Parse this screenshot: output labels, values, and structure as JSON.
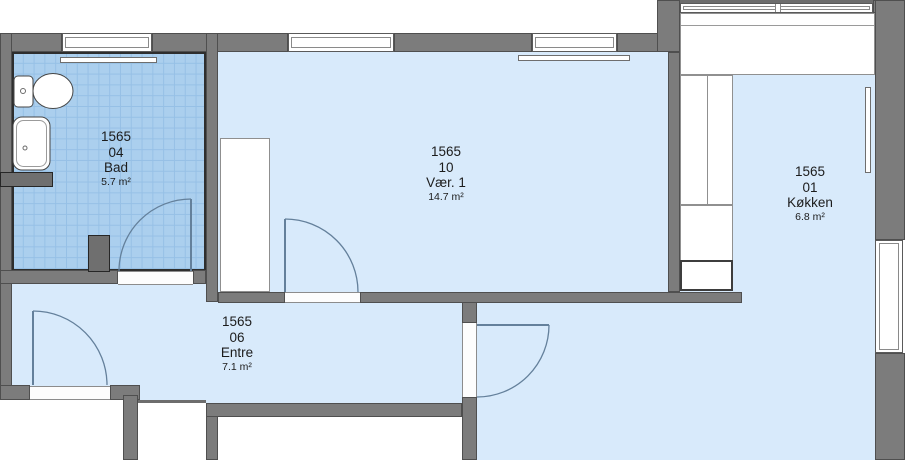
{
  "plan": {
    "unit_id": "1565",
    "rooms": {
      "bad": {
        "id": "1565",
        "no": "04",
        "name": "Bad",
        "area": "5.7 m²"
      },
      "vaer1": {
        "id": "1565",
        "no": "10",
        "name": "Vær. 1",
        "area": "14.7 m²"
      },
      "entre": {
        "id": "1565",
        "no": "06",
        "name": "Entre",
        "area": "7.1 m²"
      },
      "koekken": {
        "id": "1565",
        "no": "01",
        "name": "Køkken",
        "area": "6.8 m²"
      }
    },
    "colors": {
      "floor": "#d8eafb",
      "bath_tile": "#abcfee",
      "bath_tile_grid": "#96c0e6",
      "wall": "#7c7c7c",
      "wall_edge": "#4f4f4f",
      "door_arc": "#64809b",
      "fixture_outline": "#454545"
    }
  }
}
